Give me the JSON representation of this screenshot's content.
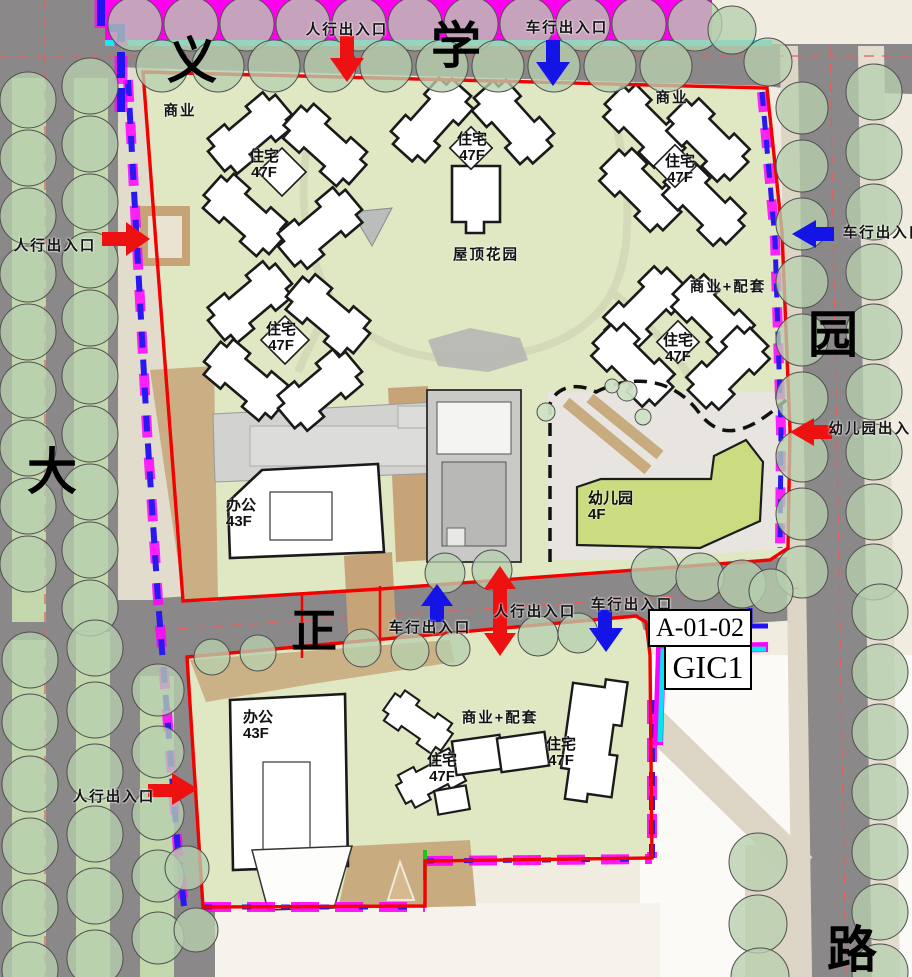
{
  "streets": {
    "north_left": "义",
    "north_right": "学",
    "east": "园",
    "west": "大",
    "middle": "正",
    "south_east": "路"
  },
  "entrances": {
    "pedestrian": "人行出入口",
    "vehicle": "车行出入口",
    "kindergarten": "幼儿园出入口"
  },
  "parcel": {
    "code": "A-01-02",
    "zoning": "GIC1"
  },
  "buildings": {
    "residential": "住宅",
    "residential_floors": "47F",
    "office": "办公",
    "office_floors": "43F",
    "commercial": "商业",
    "commercial_support": "商业+配套",
    "kindergarten": "幼儿园",
    "kindergarten_floors": "4F",
    "roof_garden": "屋顶花园"
  },
  "legend_colors": {
    "site_boundary_red": "#f40000",
    "pedestrian_arrow_red": "#ee1111",
    "vehicle_arrow_blue": "#1414e6",
    "plot_line_magenta": "#ff00ff",
    "plot_line_cyan": "#00e5ee",
    "plot_line_blue": "#2a18f0",
    "top_strip_magenta": "#ff00ef"
  }
}
